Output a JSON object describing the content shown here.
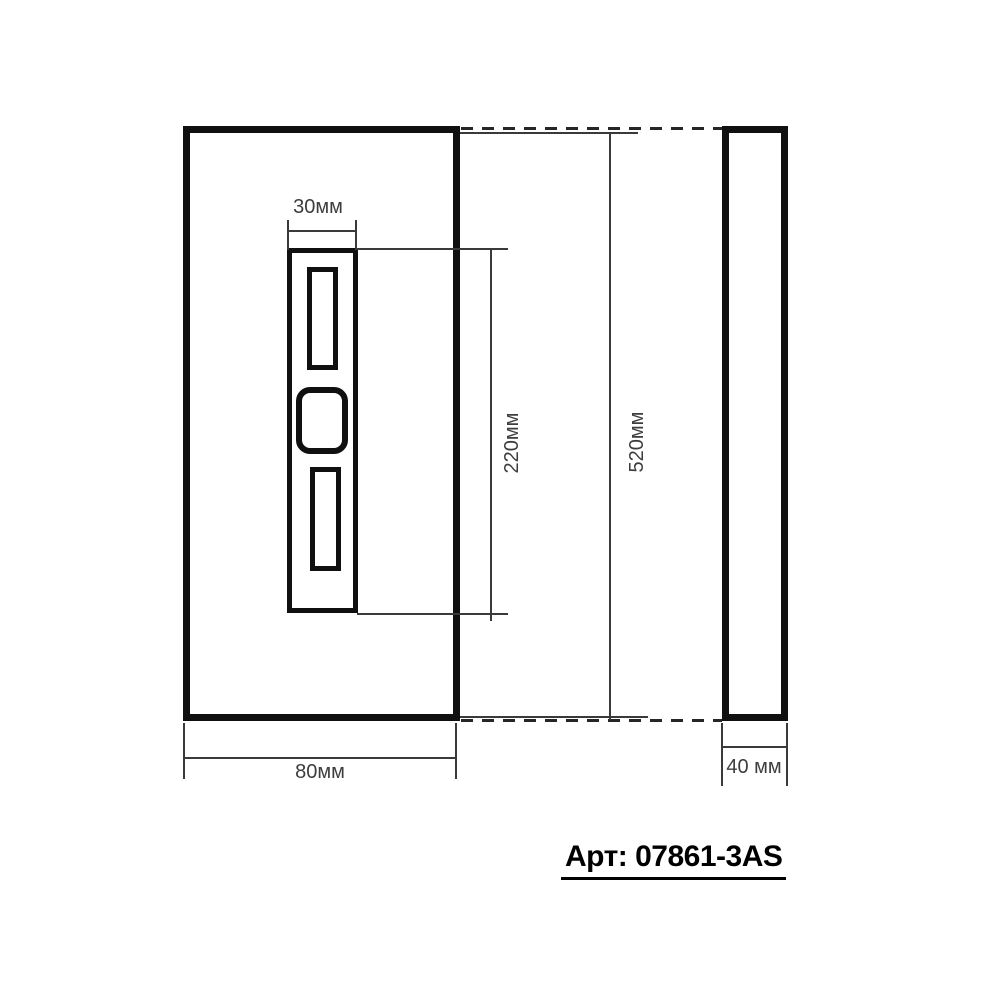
{
  "drawing": {
    "type": "technical-dimension-drawing",
    "views": [
      "front",
      "side"
    ],
    "dims": {
      "panel_width": "30мм",
      "panel_height": "220мм",
      "overall_height": "520мм",
      "overall_width": "80мм",
      "depth": "40 мм"
    },
    "article": {
      "label": "Арт: 07861-3AS"
    },
    "colors": {
      "outline": "#101010",
      "thin_line": "#3a3a3a",
      "dim_text": "#3d3d3d",
      "article_text": "#000000",
      "background": "#ffffff"
    }
  }
}
